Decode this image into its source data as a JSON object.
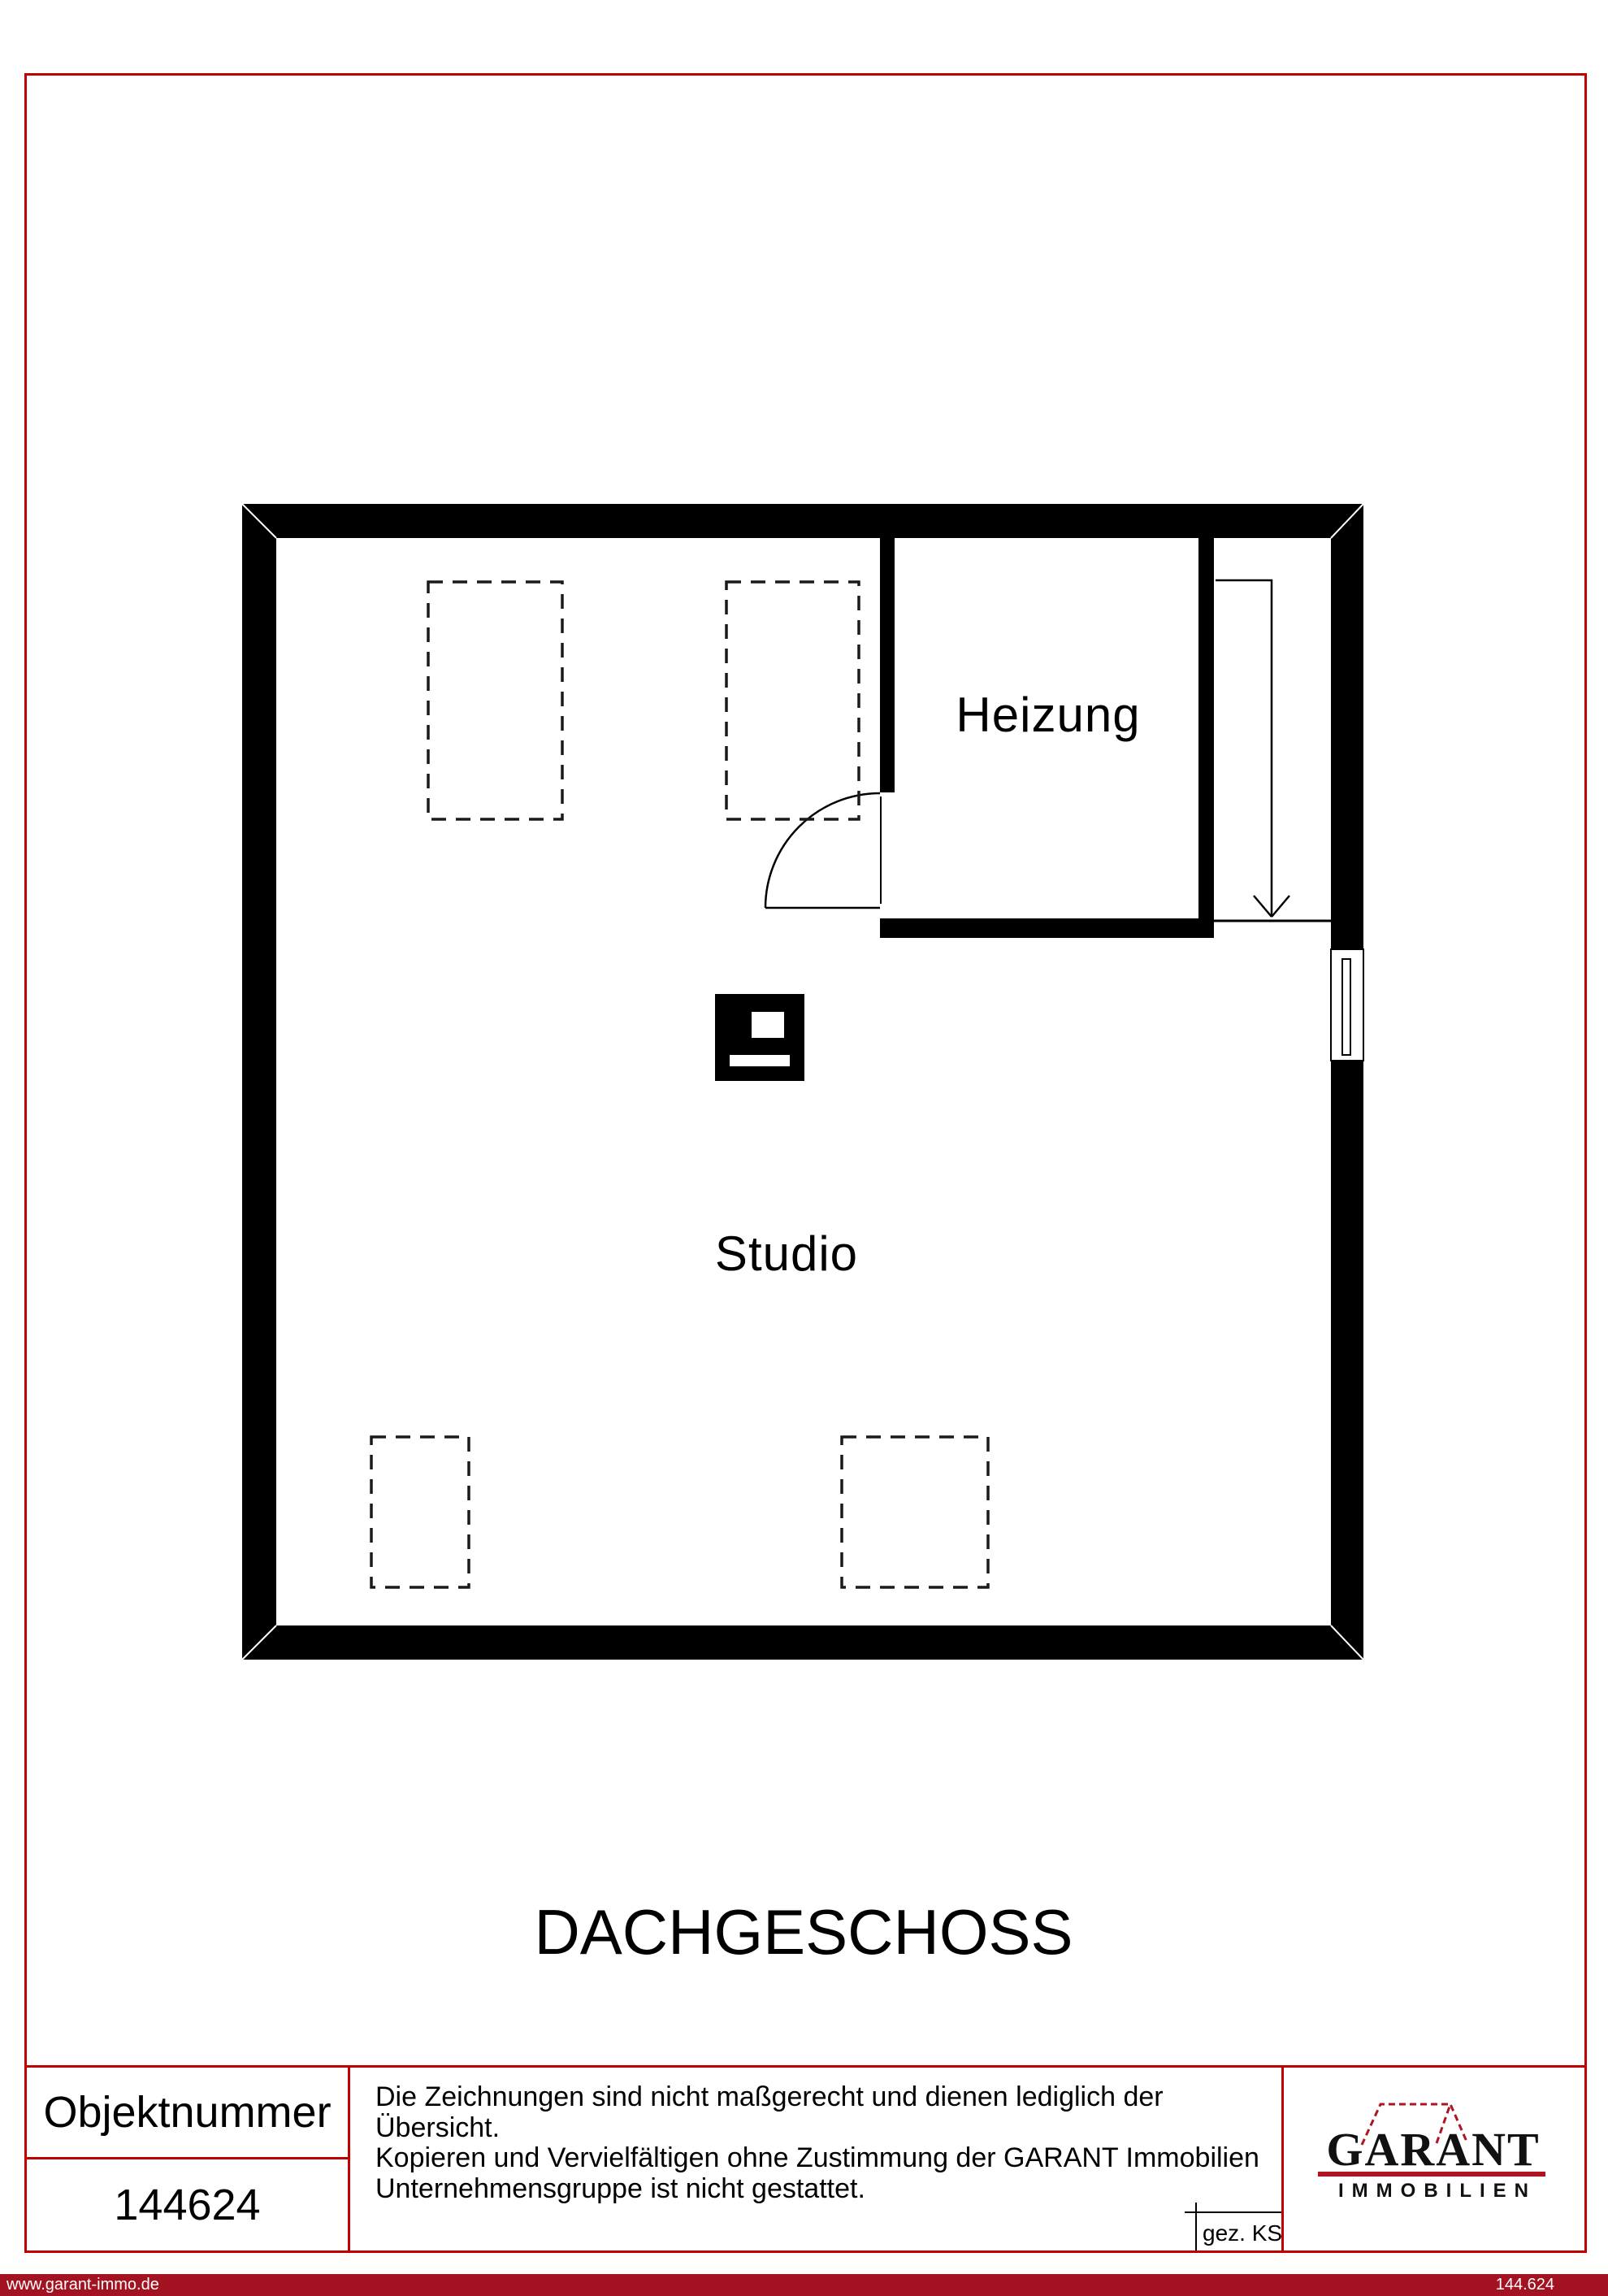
{
  "floor_plan": {
    "level_title": "DACHGESCHOSS",
    "rooms": {
      "heizung": {
        "label": "Heizung"
      },
      "studio": {
        "label": "Studio"
      }
    },
    "symbols": {
      "stair_arrow": "stairs-down-arrow",
      "door": "door-swing-arc",
      "window": "window-in-wall",
      "chimney": "chimney-block",
      "skylights": "dashed-roof-window-outline"
    }
  },
  "info_table": {
    "object_number_label": "Objektnummer",
    "object_number_value": "144624",
    "disclaimer": {
      "lines": [
        "Die Zeichnungen sind nicht maßgerecht und dienen lediglich der Übersicht.",
        "Kopieren und Vervielfältigen ohne Zustimmung der GARANT Immobilien",
        "Unternehmensgruppe ist nicht gestattet."
      ]
    },
    "drawn_by": "gez. KS"
  },
  "logo": {
    "name": "GARANT",
    "subtitle": "IMMOBILIEN"
  },
  "footer": {
    "website": "www.garant-immo.de",
    "reference": "144.624"
  },
  "colors": {
    "border_red": "#c00000",
    "footer_red": "#a31220",
    "logo_red": "#b01423"
  }
}
